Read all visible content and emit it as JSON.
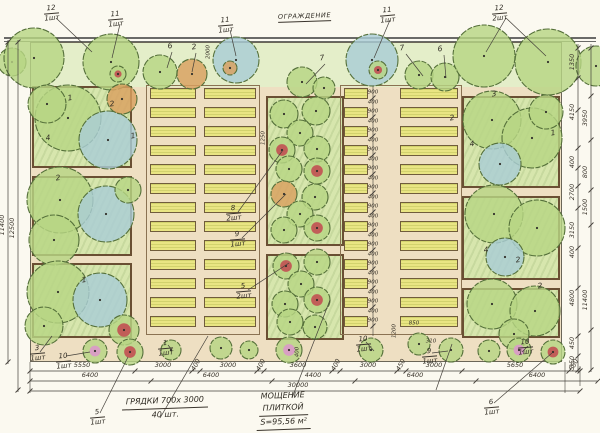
{
  "fence": {
    "label": "ОГРАЖДЕНИЕ"
  },
  "notes": {
    "beds": {
      "line1": "ГРЯДКИ  700х 3000",
      "line2": "40 шт."
    },
    "paving": {
      "line1": "МОЩЕНИЕ",
      "line2": "ПЛИТКОЙ",
      "line3": "S=95,56 м²"
    }
  },
  "colors": {
    "paper": "#fbf9f0",
    "paving": "#eedfc2",
    "lawn": "#e4eec9",
    "box_fill": "#d7e6ad",
    "box_border": "#6a4f33",
    "bed_fill": "#e9e583",
    "tree_green": "#b7d584",
    "tree_blue": "#a9cdd6",
    "tree_orange": "#d9a05f",
    "flower_red": "#c2484f",
    "flower_pink": "#dc95cc",
    "line": "#44403a",
    "fence": "#3a3a3a"
  },
  "plant_labels": [
    {
      "x": 44,
      "y": 4,
      "num": "12",
      "count": "1шт"
    },
    {
      "x": 108,
      "y": 10,
      "num": "11",
      "count": "1шт"
    },
    {
      "x": 218,
      "y": 16,
      "num": "11",
      "count": "1шт"
    },
    {
      "x": 380,
      "y": 6,
      "num": "11",
      "count": "1шт"
    },
    {
      "x": 492,
      "y": 4,
      "num": "12",
      "count": "2шт"
    },
    {
      "x": 30,
      "y": 344,
      "num": "3",
      "count": "1шт"
    },
    {
      "x": 56,
      "y": 352,
      "num": "10",
      "count": "1шт"
    },
    {
      "x": 158,
      "y": 339,
      "num": "1",
      "count": "1шт"
    },
    {
      "x": 226,
      "y": 204,
      "num": "8",
      "count": "2шт"
    },
    {
      "x": 230,
      "y": 230,
      "num": "9",
      "count": "1шт"
    },
    {
      "x": 236,
      "y": 282,
      "num": "5",
      "count": "2шт"
    },
    {
      "x": 90,
      "y": 408,
      "num": "5",
      "count": "1шт"
    },
    {
      "x": 356,
      "y": 335,
      "num": "10",
      "count": "1шт"
    },
    {
      "x": 422,
      "y": 347,
      "num": "9",
      "count": "1шт"
    },
    {
      "x": 518,
      "y": 338,
      "num": "10",
      "count": "1шт"
    },
    {
      "x": 484,
      "y": 398,
      "num": "6",
      "count": "1шт"
    }
  ],
  "tree_numbers": [
    {
      "x": 70,
      "y": 98,
      "t": "1"
    },
    {
      "x": 112,
      "y": 104,
      "t": "2"
    },
    {
      "x": 48,
      "y": 138,
      "t": "4"
    },
    {
      "x": 133,
      "y": 136,
      "t": "1"
    },
    {
      "x": 58,
      "y": 178,
      "t": "2"
    },
    {
      "x": 84,
      "y": 280,
      "t": "1"
    },
    {
      "x": 170,
      "y": 46,
      "t": "6"
    },
    {
      "x": 194,
      "y": 47,
      "t": "2"
    },
    {
      "x": 322,
      "y": 58,
      "t": "7"
    },
    {
      "x": 402,
      "y": 48,
      "t": "7"
    },
    {
      "x": 440,
      "y": 49,
      "t": "6"
    },
    {
      "x": 494,
      "y": 94,
      "t": "3"
    },
    {
      "x": 452,
      "y": 118,
      "t": "2"
    },
    {
      "x": 553,
      "y": 133,
      "t": "1"
    },
    {
      "x": 472,
      "y": 144,
      "t": "4"
    },
    {
      "x": 518,
      "y": 260,
      "t": "2"
    },
    {
      "x": 486,
      "y": 250,
      "t": "4"
    },
    {
      "x": 540,
      "y": 286,
      "t": "2"
    }
  ],
  "small_dims": [
    {
      "x": 209,
      "y": 52,
      "t": "2000",
      "rot": 1
    },
    {
      "x": 264,
      "y": 138,
      "t": "1250",
      "rot": 1
    },
    {
      "x": 395,
      "y": 331,
      "t": "1200",
      "rot": 1
    },
    {
      "x": 414,
      "y": 324,
      "t": "850",
      "rot": 0
    },
    {
      "x": 431,
      "y": 342,
      "t": "310",
      "rot": 0
    },
    {
      "x": 298,
      "y": 352,
      "t": "400",
      "rot": 1
    }
  ],
  "dim_rows": [
    {
      "y": 371,
      "ticks": [
        30,
        135,
        192,
        200,
        257,
        264,
        332,
        340,
        397,
        406,
        462,
        569,
        580
      ],
      "labels": [
        {
          "x": 82,
          "t": "5550"
        },
        {
          "x": 163,
          "t": "3000"
        },
        {
          "x": 196,
          "t": "400",
          "s": 1
        },
        {
          "x": 228,
          "t": "3000"
        },
        {
          "x": 261,
          "t": "400",
          "s": 1
        },
        {
          "x": 298,
          "t": "3600"
        },
        {
          "x": 336,
          "t": "400",
          "s": 1
        },
        {
          "x": 368,
          "t": "3000"
        },
        {
          "x": 401,
          "t": "450",
          "s": 1
        },
        {
          "x": 434,
          "t": "3000"
        },
        {
          "x": 515,
          "t": "5650"
        },
        {
          "x": 574,
          "t": "550",
          "s": 1
        }
      ]
    },
    {
      "y": 381,
      "ticks": [
        30,
        151,
        272,
        355,
        476,
        598
      ],
      "labels": [
        {
          "x": 90,
          "t": "6400"
        },
        {
          "x": 211,
          "t": "6400"
        },
        {
          "x": 313,
          "t": "4400"
        },
        {
          "x": 415,
          "t": "6400"
        },
        {
          "x": 537,
          "t": "6400"
        }
      ]
    },
    {
      "y": 391,
      "ticks": [
        30,
        580
      ],
      "labels": [
        {
          "x": 298,
          "t": "30000"
        }
      ]
    }
  ],
  "v_chains": [
    {
      "x": 8,
      "y1": 40,
      "y2": 364,
      "ticks": [
        42,
        362
      ],
      "labels": [
        {
          "y": 225,
          "t": "11400"
        }
      ]
    },
    {
      "x": 18,
      "y1": 40,
      "y2": 392,
      "ticks": [
        42,
        390
      ],
      "labels": [
        {
          "y": 228,
          "t": "12500"
        }
      ]
    },
    {
      "x": 578,
      "y1": 44,
      "y2": 372,
      "ticks": [
        48,
        78,
        110,
        148,
        168,
        186,
        208,
        248,
        288,
        336,
        356,
        370
      ],
      "labels": [
        {
          "y": 62,
          "t": "1350"
        },
        {
          "y": 112,
          "t": "4150"
        },
        {
          "y": 162,
          "t": "400"
        },
        {
          "y": 192,
          "t": "2700"
        },
        {
          "y": 230,
          "t": "3150"
        },
        {
          "y": 252,
          "t": "400"
        },
        {
          "y": 298,
          "t": "4800"
        },
        {
          "y": 343,
          "t": "450"
        },
        {
          "y": 362,
          "t": "350"
        }
      ]
    },
    {
      "x": 591,
      "y1": 44,
      "y2": 372,
      "ticks": [
        48,
        96,
        140,
        190,
        225,
        330,
        370
      ],
      "labels": [
        {
          "y": 118,
          "t": "3950"
        },
        {
          "y": 172,
          "t": "800"
        },
        {
          "y": 207,
          "t": "1500"
        },
        {
          "y": 300,
          "t": "11400"
        }
      ]
    }
  ],
  "center_chain": {
    "x": 373,
    "y1": 86,
    "y2": 336,
    "y0": 88,
    "pitch": 19,
    "count": 13,
    "bed": "900",
    "gap": "400"
  },
  "beds": {
    "columns": [
      {
        "x": 150,
        "w": 46
      },
      {
        "x": 204,
        "w": 52
      },
      {
        "x": 344,
        "w": 24
      },
      {
        "x": 400,
        "w": 58
      }
    ],
    "y0": 88,
    "h": 11,
    "pitch": 19,
    "count": 13
  },
  "boxes": [
    {
      "x": 32,
      "y": 86,
      "w": 100,
      "h": 82
    },
    {
      "x": 32,
      "y": 176,
      "w": 100,
      "h": 80
    },
    {
      "x": 32,
      "y": 263,
      "w": 100,
      "h": 75
    },
    {
      "x": 266,
      "y": 96,
      "w": 78,
      "h": 150
    },
    {
      "x": 266,
      "y": 254,
      "w": 78,
      "h": 86
    },
    {
      "x": 462,
      "y": 96,
      "w": 98,
      "h": 92
    },
    {
      "x": 462,
      "y": 196,
      "w": 98,
      "h": 84
    },
    {
      "x": 462,
      "y": 288,
      "w": 98,
      "h": 50
    }
  ],
  "bed_blocks": [
    {
      "x": 146,
      "y": 85,
      "w": 114,
      "h": 250
    },
    {
      "x": 340,
      "y": 85,
      "w": 122,
      "h": 250
    }
  ],
  "trees": [
    {
      "x": 12,
      "y": 62,
      "r": 14,
      "t": "g"
    },
    {
      "x": 34,
      "y": 58,
      "r": 30,
      "t": "g"
    },
    {
      "x": 111,
      "y": 62,
      "r": 28,
      "t": "g"
    },
    {
      "x": 118,
      "y": 74,
      "r": 8,
      "t": "f"
    },
    {
      "x": 160,
      "y": 72,
      "r": 17,
      "t": "g"
    },
    {
      "x": 192,
      "y": 74,
      "r": 15,
      "t": "o"
    },
    {
      "x": 236,
      "y": 60,
      "r": 23,
      "t": "b"
    },
    {
      "x": 230,
      "y": 68,
      "r": 7,
      "t": "o"
    },
    {
      "x": 372,
      "y": 60,
      "r": 26,
      "t": "b"
    },
    {
      "x": 378,
      "y": 70,
      "r": 9,
      "t": "f"
    },
    {
      "x": 419,
      "y": 75,
      "r": 14,
      "t": "g"
    },
    {
      "x": 445,
      "y": 77,
      "r": 14,
      "t": "g"
    },
    {
      "x": 484,
      "y": 56,
      "r": 31,
      "t": "g"
    },
    {
      "x": 548,
      "y": 62,
      "r": 33,
      "t": "g"
    },
    {
      "x": 596,
      "y": 66,
      "r": 20,
      "t": "g"
    },
    {
      "x": 68,
      "y": 118,
      "r": 33,
      "t": "g"
    },
    {
      "x": 108,
      "y": 140,
      "r": 29,
      "t": "b"
    },
    {
      "x": 47,
      "y": 104,
      "r": 19,
      "t": "g"
    },
    {
      "x": 122,
      "y": 99,
      "r": 15,
      "t": "o"
    },
    {
      "x": 60,
      "y": 200,
      "r": 33,
      "t": "g"
    },
    {
      "x": 106,
      "y": 214,
      "r": 28,
      "t": "b"
    },
    {
      "x": 54,
      "y": 240,
      "r": 25,
      "t": "g"
    },
    {
      "x": 128,
      "y": 190,
      "r": 13,
      "t": "g"
    },
    {
      "x": 58,
      "y": 292,
      "r": 31,
      "t": "g"
    },
    {
      "x": 100,
      "y": 300,
      "r": 27,
      "t": "b"
    },
    {
      "x": 44,
      "y": 326,
      "r": 19,
      "t": "g"
    },
    {
      "x": 124,
      "y": 330,
      "r": 15,
      "t": "f"
    },
    {
      "x": 302,
      "y": 82,
      "r": 15,
      "t": "g"
    },
    {
      "x": 324,
      "y": 88,
      "r": 11,
      "t": "g"
    },
    {
      "x": 284,
      "y": 114,
      "r": 14,
      "t": "g"
    },
    {
      "x": 316,
      "y": 111,
      "r": 14,
      "t": "g"
    },
    {
      "x": 300,
      "y": 133,
      "r": 13,
      "t": "g"
    },
    {
      "x": 282,
      "y": 150,
      "r": 13,
      "t": "f"
    },
    {
      "x": 317,
      "y": 149,
      "r": 13,
      "t": "g"
    },
    {
      "x": 289,
      "y": 169,
      "r": 13,
      "t": "g"
    },
    {
      "x": 317,
      "y": 171,
      "r": 13,
      "t": "f"
    },
    {
      "x": 284,
      "y": 194,
      "r": 13,
      "t": "o"
    },
    {
      "x": 315,
      "y": 197,
      "r": 13,
      "t": "g"
    },
    {
      "x": 300,
      "y": 214,
      "r": 13,
      "t": "g"
    },
    {
      "x": 284,
      "y": 230,
      "r": 13,
      "t": "g"
    },
    {
      "x": 317,
      "y": 228,
      "r": 13,
      "t": "f"
    },
    {
      "x": 286,
      "y": 266,
      "r": 13,
      "t": "f"
    },
    {
      "x": 317,
      "y": 262,
      "r": 13,
      "t": "g"
    },
    {
      "x": 301,
      "y": 284,
      "r": 13,
      "t": "g"
    },
    {
      "x": 285,
      "y": 304,
      "r": 13,
      "t": "g"
    },
    {
      "x": 317,
      "y": 300,
      "r": 13,
      "t": "f"
    },
    {
      "x": 290,
      "y": 322,
      "r": 13,
      "t": "g"
    },
    {
      "x": 315,
      "y": 327,
      "r": 12,
      "t": "g"
    },
    {
      "x": 492,
      "y": 120,
      "r": 29,
      "t": "g"
    },
    {
      "x": 532,
      "y": 138,
      "r": 30,
      "t": "g"
    },
    {
      "x": 500,
      "y": 164,
      "r": 21,
      "t": "b"
    },
    {
      "x": 546,
      "y": 112,
      "r": 17,
      "t": "g"
    },
    {
      "x": 494,
      "y": 214,
      "r": 29,
      "t": "g"
    },
    {
      "x": 537,
      "y": 228,
      "r": 28,
      "t": "g"
    },
    {
      "x": 505,
      "y": 257,
      "r": 19,
      "t": "b"
    },
    {
      "x": 492,
      "y": 304,
      "r": 25,
      "t": "g"
    },
    {
      "x": 535,
      "y": 311,
      "r": 25,
      "t": "g"
    },
    {
      "x": 514,
      "y": 334,
      "r": 15,
      "t": "g"
    },
    {
      "x": 95,
      "y": 351,
      "r": 12,
      "t": "p"
    },
    {
      "x": 130,
      "y": 352,
      "r": 13,
      "t": "f"
    },
    {
      "x": 171,
      "y": 350,
      "r": 10,
      "t": "g"
    },
    {
      "x": 221,
      "y": 348,
      "r": 11,
      "t": "g"
    },
    {
      "x": 249,
      "y": 350,
      "r": 9,
      "t": "g"
    },
    {
      "x": 289,
      "y": 350,
      "r": 13,
      "t": "p"
    },
    {
      "x": 371,
      "y": 350,
      "r": 12,
      "t": "g"
    },
    {
      "x": 419,
      "y": 344,
      "r": 11,
      "t": "g"
    },
    {
      "x": 451,
      "y": 350,
      "r": 12,
      "t": "g"
    },
    {
      "x": 489,
      "y": 351,
      "r": 11,
      "t": "g"
    },
    {
      "x": 519,
      "y": 350,
      "r": 12,
      "t": "p"
    },
    {
      "x": 553,
      "y": 352,
      "r": 12,
      "t": "f"
    }
  ],
  "leaders": [
    [
      56,
      18,
      92,
      52
    ],
    [
      120,
      24,
      112,
      58
    ],
    [
      230,
      30,
      236,
      56
    ],
    [
      390,
      20,
      374,
      58
    ],
    [
      506,
      18,
      486,
      52
    ],
    [
      506,
      18,
      546,
      56
    ],
    [
      172,
      52,
      167,
      68
    ],
    [
      196,
      53,
      192,
      72
    ],
    [
      325,
      64,
      306,
      84
    ],
    [
      406,
      54,
      423,
      76
    ],
    [
      444,
      55,
      446,
      78
    ],
    [
      238,
      212,
      283,
      150
    ],
    [
      242,
      238,
      286,
      194
    ],
    [
      248,
      290,
      289,
      263
    ],
    [
      40,
      352,
      52,
      336
    ],
    [
      66,
      356,
      90,
      352
    ],
    [
      100,
      413,
      128,
      357
    ],
    [
      168,
      345,
      172,
      350
    ],
    [
      366,
      342,
      374,
      351
    ],
    [
      432,
      353,
      448,
      351
    ],
    [
      528,
      346,
      522,
      352
    ],
    [
      494,
      403,
      552,
      353
    ],
    [
      160,
      418,
      208,
      336
    ],
    [
      292,
      398,
      330,
      300
    ],
    [
      436,
      390,
      452,
      344
    ]
  ]
}
